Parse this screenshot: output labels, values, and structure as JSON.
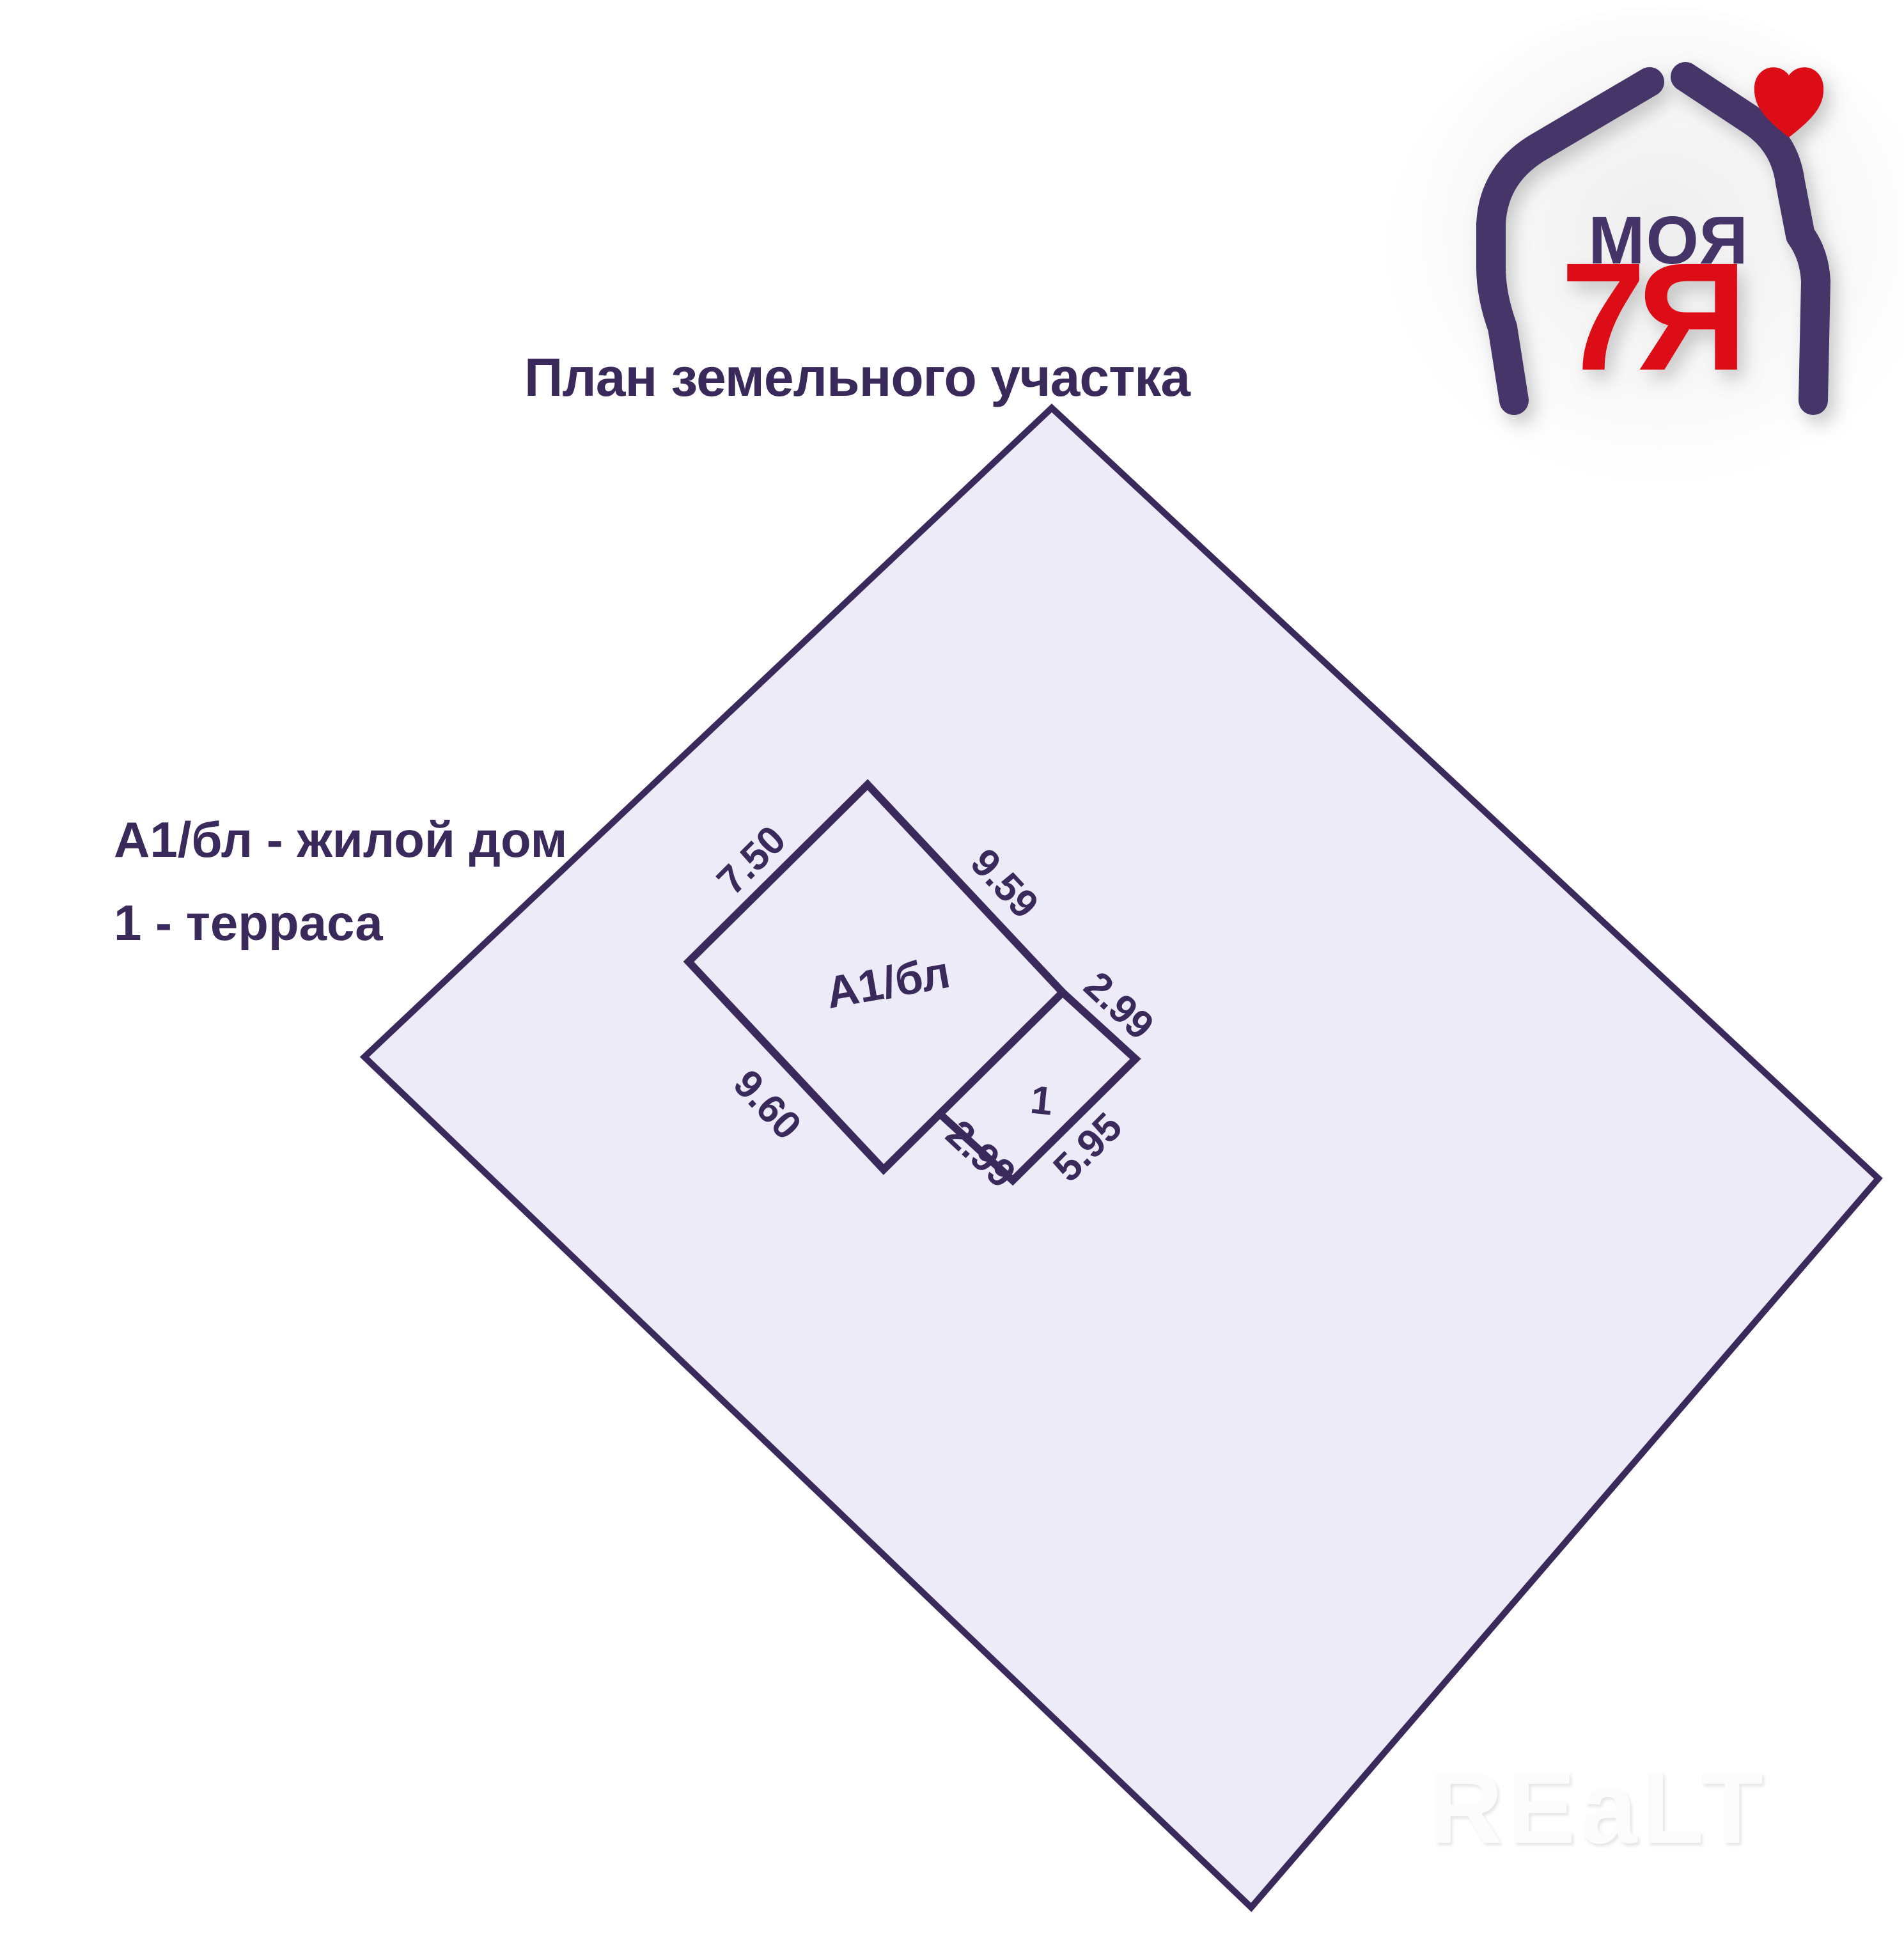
{
  "colors": {
    "primary": "#3a2a5c",
    "logo-purple": "#453467",
    "logo-red": "#dc1017",
    "land-fill": "#edebf7",
    "background": "#ffffff",
    "watermark": "#fcfcfc"
  },
  "title": "План земельного участка",
  "legend": {
    "line1": "А1/бл - жилой дом",
    "line2": "1 - терраса"
  },
  "plan": {
    "house_label": "А1/бл",
    "terrace_label": "1",
    "dimensions": {
      "house_top_left": "7.50",
      "house_top_right": "9.59",
      "terrace_top_right": "2.99",
      "house_bottom_left": "9.60",
      "terrace_bottom_left": "2.99",
      "terrace_bottom_right": "5.95"
    }
  },
  "logo": {
    "word_top": "МОЯ",
    "word_bottom": "7Я"
  },
  "watermark": "REaLT"
}
